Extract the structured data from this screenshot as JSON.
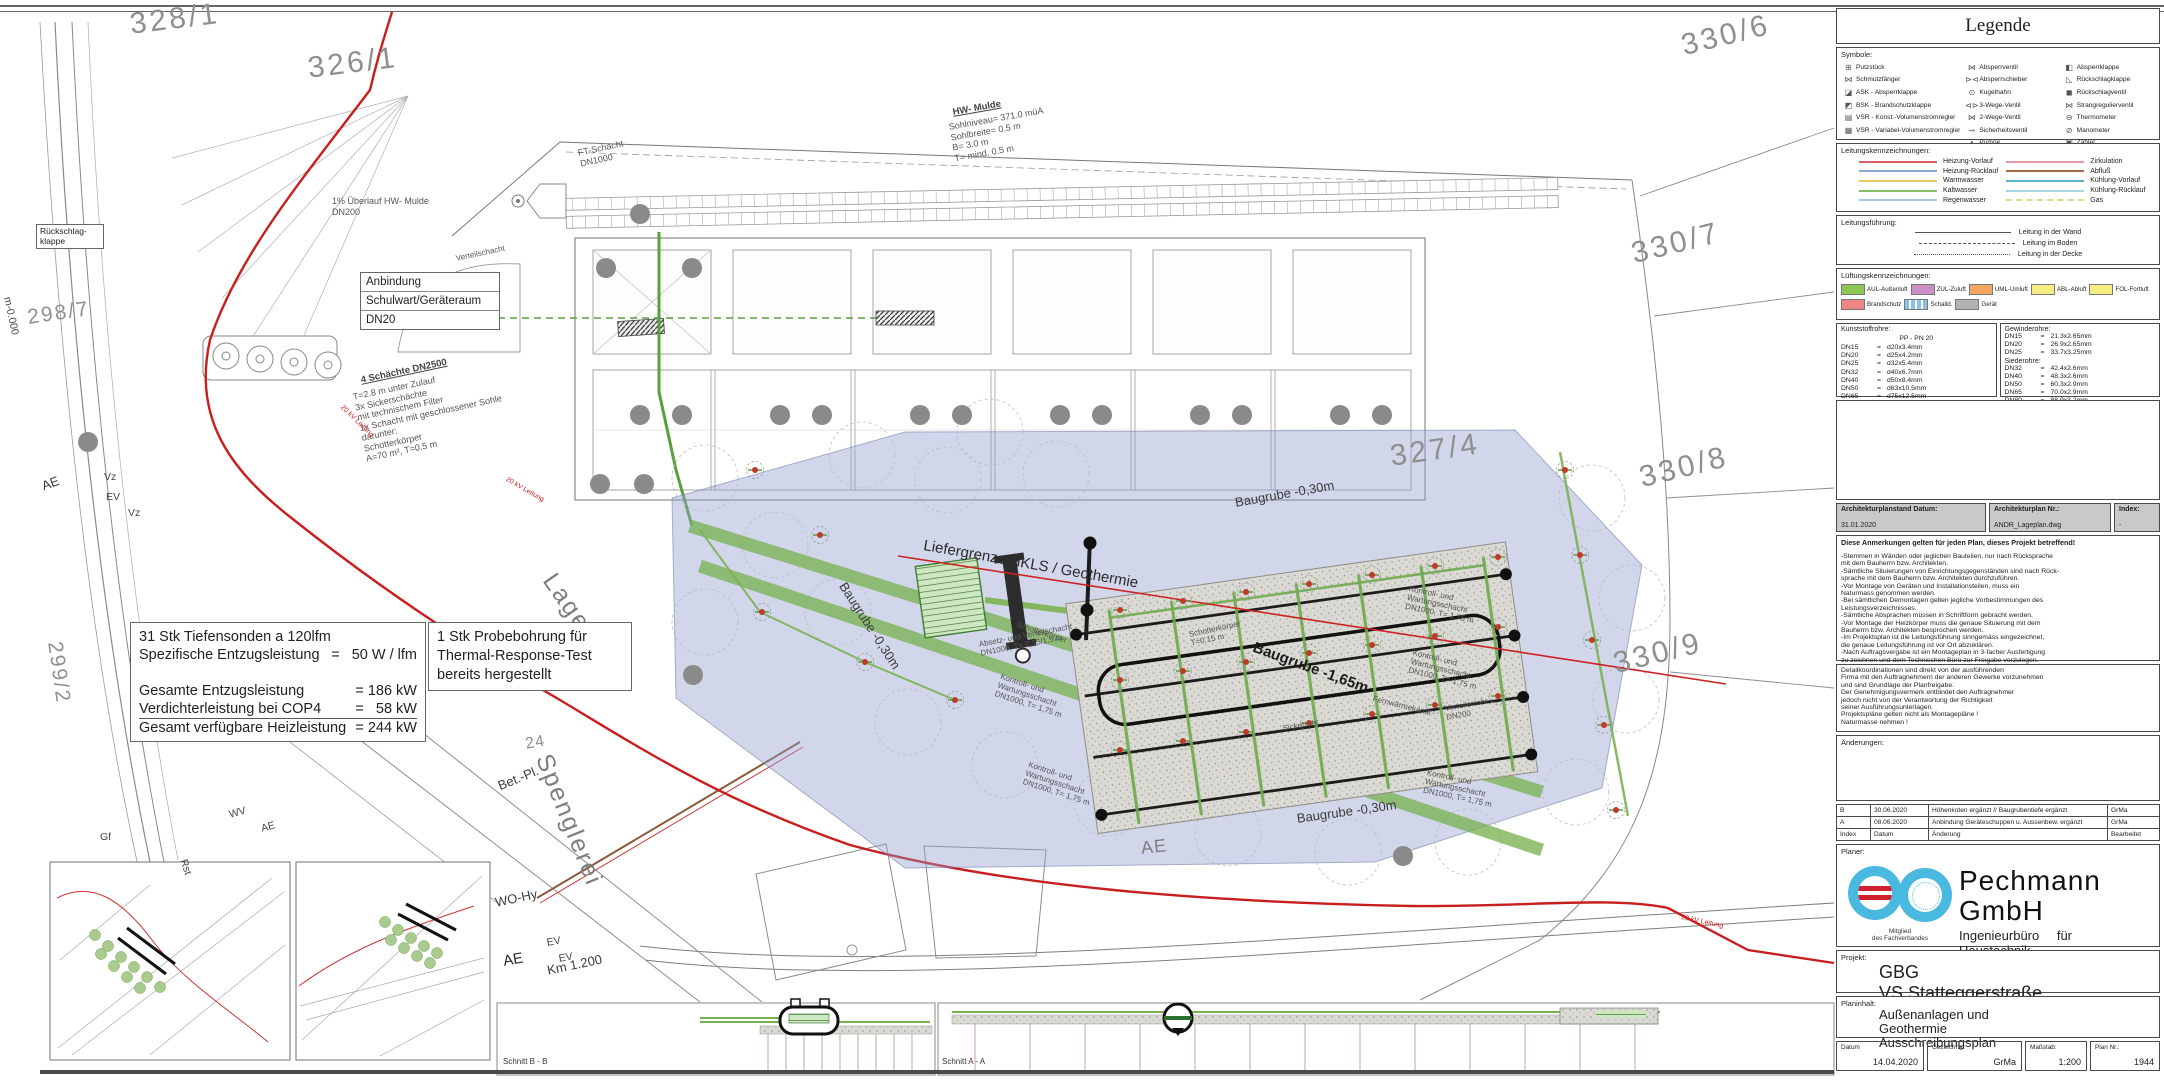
{
  "legend": {
    "title": "Legende",
    "symbols_label": "Symbole:",
    "symbols_col1": [
      {
        "icon": "⊞",
        "name": "putzstueck-icon",
        "label": "Putzstück"
      },
      {
        "icon": "⋈",
        "name": "schmutzfaenger-icon",
        "label": "Schmutzfänger"
      },
      {
        "icon": "◪",
        "name": "ask-icon",
        "label": "ASK  - Absperrklappe"
      },
      {
        "icon": "◩",
        "name": "bsk-icon",
        "label": "BSK  - Brandschutzklappe"
      },
      {
        "icon": "▤",
        "name": "vsr-konst-icon",
        "label": "VSR - Konst.-Volumenstromregler"
      },
      {
        "icon": "▦",
        "name": "vsr-var-icon",
        "label": "VSR - Variabel-Volumenstromregler"
      }
    ],
    "symbols_col2": [
      {
        "icon": "⋈",
        "name": "absperrventil-icon",
        "label": "Absperrventil"
      },
      {
        "icon": "⊳⊲",
        "name": "absperrschieber-icon",
        "label": "Absperrschieber"
      },
      {
        "icon": "⊙",
        "name": "kugelhahn-icon",
        "label": "Kugelhahn"
      },
      {
        "icon": "⊲⊳",
        "name": "drei-wege-ventil-icon",
        "label": "3-Wege-Ventil"
      },
      {
        "icon": "⋈",
        "name": "zwei-wege-ventil-icon",
        "label": "2-Wege-Ventil"
      },
      {
        "icon": "⊸",
        "name": "sicherheitsventil-icon",
        "label": "Sicherheitsventil"
      },
      {
        "icon": "▲",
        "name": "pumpe-icon",
        "label": "Pumpe"
      }
    ],
    "symbols_col3": [
      {
        "icon": "◧",
        "name": "absperrklappe-icon",
        "label": "Absperrklappe"
      },
      {
        "icon": "◺",
        "name": "rueckschlagklappe-icon",
        "label": "Rückschlagklappe"
      },
      {
        "icon": "◼",
        "name": "rueckschlagventil-icon",
        "label": "Rückschlagventil"
      },
      {
        "icon": "⋈",
        "name": "strangregulierventil-icon",
        "label": "Strangregulierventil"
      },
      {
        "icon": "⊖",
        "name": "thermometer-icon",
        "label": "Thermometer"
      },
      {
        "icon": "⊘",
        "name": "manometer-icon",
        "label": "Manometer"
      },
      {
        "icon": "▣",
        "name": "zaehler-icon",
        "label": "Zähler"
      }
    ],
    "line_markings_label": "Leitungskennzeichnungen:",
    "lines_left": [
      {
        "label": "Heizung-Vorlauf",
        "color": "#d96060"
      },
      {
        "label": "Heizung-Rücklauf",
        "color": "#8aa6d6"
      },
      {
        "label": "Warmwasser",
        "color": "#e6cb5a"
      },
      {
        "label": "Kaltwasser",
        "color": "#86bd6a"
      },
      {
        "label": "Regenwasser",
        "color": "#a6cbe8"
      }
    ],
    "lines_right": [
      {
        "label": "Zirkulation",
        "color": "#e59aa8"
      },
      {
        "label": "Abfluß",
        "color": "#a8674a"
      },
      {
        "label": "Kühlung-Vorlauf",
        "color": "#55b4c8"
      },
      {
        "label": "Kühlung-Rücklauf",
        "color": "#a9d6e6"
      },
      {
        "label": "Gas",
        "color": "#ded98a",
        "dash": true
      }
    ],
    "routing_label": "Leitungsführung:",
    "routing": [
      {
        "label": "Leitung in der Wand",
        "style": "solid"
      },
      {
        "label": "Leitung im Boden",
        "style": "dashed"
      },
      {
        "label": "Leitung in der Decke",
        "style": "dotted"
      }
    ],
    "vent_label": "Lüftungskennzeichnungen:",
    "vent_row1": [
      {
        "label": "AUL-Außenluft",
        "color": "#8cc653"
      },
      {
        "label": "ZUL-Zuluft",
        "color": "#cc8fc5"
      },
      {
        "label": "UML-Umluft",
        "color": "#f2a95f"
      },
      {
        "label": "ABL-Abluft",
        "color": "#f4ee82"
      },
      {
        "label": "FOL-Fortluft",
        "color": "#f4ee82"
      }
    ],
    "vent_row2": [
      {
        "label": "Brandschutz",
        "color": "#ef8686"
      },
      {
        "label": "Schalld.",
        "color": "#8cc0ea",
        "striped": true
      },
      {
        "label": "Gerät",
        "color": "#b3b3b3"
      }
    ],
    "plastic_title": "Kunststoffrohre:",
    "plastic_sub": "PP  -  PN 20",
    "plastic_rows": [
      [
        "DN15",
        "=",
        "d20x3.4mm"
      ],
      [
        "DN20",
        "=",
        "d25x4.2mm"
      ],
      [
        "DN25",
        "=",
        "d32x5.4mm"
      ],
      [
        "DN32",
        "=",
        "d40x6.7mm"
      ],
      [
        "DN40",
        "=",
        "d50x8.4mm"
      ],
      [
        "DN50",
        "=",
        "d63x10.5mm"
      ],
      [
        "DN65",
        "=",
        "d75x12.5mm"
      ],
      [
        "DN80",
        "=",
        "d90x15mm"
      ]
    ],
    "threaded_title": "Gewinderohre:",
    "threaded_rows": [
      [
        "DN15",
        "=",
        "21.3x2.65mm"
      ],
      [
        "DN20",
        "=",
        "26.9x2.65mm"
      ],
      [
        "DN25",
        "=",
        "33.7x3.25mm"
      ]
    ],
    "boiler_title": "Siederohre:",
    "boiler_rows": [
      [
        "DN32",
        "=",
        "42.4x2.6mm"
      ],
      [
        "DN40",
        "=",
        "48.3x2.6mm"
      ],
      [
        "DN50",
        "=",
        "60.3x2.9mm"
      ],
      [
        "DN65",
        "=",
        "70.0x2.9mm"
      ],
      [
        "DN80",
        "=",
        "88.9x3.2mm"
      ],
      [
        "DN100",
        "=",
        "114.3x3.6mm"
      ]
    ]
  },
  "plan_meta": {
    "arch_date_label": "Architekturplanstand Datum:",
    "arch_date": "31.01.2020",
    "arch_nr_label": "Architekturplan Nr.:",
    "arch_nr": "ANDR_Lageplan.dwg",
    "index_label": "Index:",
    "index_value": "-"
  },
  "notes": {
    "title": "Diese Anmerkungen gelten für jeden Plan, dieses Projekt betreffend!",
    "lines": [
      "-Stemmen in Wänden oder jeglichen Bauteilen, nur nach Rücksprache",
      " mit dem Bauherrn bzw. Architekten.",
      "-Sämtliche Situierungen von Einrichtungsgegenständen sind nach Rück-",
      " sprache mit dem Bauherrn bzw. Architekten durchzuführen.",
      "-Vor Montage von Geräten und Installationsteilen, muss ein",
      " Naturmass genommen werden.",
      "-Bei sämtlichen Demontagen gelten jegliche Vorbestimmungen des",
      " Leistungsverzeichnisses.",
      "-Sämtliche Absprachen müssen in Schriftform gebracht werden.",
      "-Vor Montage der Heizkörper muss die genaue Situierung mit dem",
      " Bauherrn bzw. Architekten besprochen werden.",
      "-Im Projektsplan ist die Leitungsführung sinngemäss eingezeichnet,",
      " die genaue Leitungsführung ist vor Ort abzuklären.",
      "-Nach Auftragsvergabe ist ein Montageplan in 3-facher Ausfertigung",
      " zu zeichnen und dem Technischen Büro zur Freigabe vorzulegen."
    ]
  },
  "coordination_lines": [
    "Detailkoordinationen sind direkt von der ausführenden",
    "Firma mit den Auftragnehmern der anderen Gewerke vorzunehmen",
    "und sind Grundlage der Planfreigabe.",
    "Der Genehmigungsvermerk entbindet den Auftragnehmer",
    "jedoch nicht von der Verantwortung der Richtigkeit",
    "seiner Ausführungsunterlagen.",
    "Projektspläne gelten nicht als Montagepläne !",
    "Naturmasse nehmen !"
  ],
  "changes_label": "Änderungen:",
  "revisions": {
    "rows": [
      {
        "index": "B",
        "date": "30.06.2020",
        "change": "Höhenkoten ergänzt // Baugrubentiefe ergänzt",
        "by": "GrMa"
      },
      {
        "index": "A",
        "date": "08.06.2020",
        "change": "Anbindung Geräteschuppen u. Aussenbew. ergänzt",
        "by": "GrMa"
      }
    ],
    "header": {
      "index": "Index",
      "date": "Datum",
      "change": "Änderung",
      "by": "Bearbeitet"
    }
  },
  "planner": {
    "label": "Planer:",
    "company": "Pechmann GmbH",
    "subtitle": "Ingenieurbüro für Haustechnik",
    "addr1": "Grazer Straße 48f, A - 8062 Kumberg",
    "addr2": "Tel.: 03132/5485 Fax.: 03132/5485-16",
    "addr3": "e-mail: office@tb-pechmann.at",
    "membership": "Mitglied\ndes Fachverbandes"
  },
  "project": {
    "label": "Projekt:",
    "line1": "GBG",
    "line2": "VS Statteggerstraße"
  },
  "content": {
    "label": "Planinhalt:",
    "lines": [
      "Außenanlagen und",
      "Geothermie",
      "Ausschreibungsplan"
    ]
  },
  "footer": {
    "date_label": "Datum",
    "date": "14.04.2020",
    "drawn_label": "Gezeichnet",
    "drawn": "GrMa",
    "scale_label": "Maßstab:",
    "scale": "1:200",
    "plan_label": "Plan Nr.:",
    "plan_nr": "1944"
  },
  "plan": {
    "colors": {
      "kv_line": "#c81e1e",
      "pipe": "#4e9a3c",
      "borehole": "#c0392b",
      "tree": "#8a8a8a",
      "excavation": "rgba(148,158,204,0.42)"
    },
    "boxes": {
      "anbindung": {
        "lines": [
          "Anbindung",
          "Schulwart/Geräteraum",
          "DN20"
        ]
      },
      "rueckschlag": {
        "text": "Rückschlag-\nklappe"
      },
      "sonden": {
        "rows": [
          [
            "31 Stk Tiefensonden a 120lfm",
            ""
          ],
          [
            "Spezifische Entzugsleistung",
            "=   50 W / lfm"
          ],
          [
            "",
            ""
          ],
          [
            "Gesamte Entzugsleistung",
            "= 186 kW"
          ],
          [
            "Verdichterleistung bei COP4",
            "=   58 kW"
          ],
          [
            "Gesamt verfügbare Heizleistung",
            "= 244 kW"
          ]
        ]
      },
      "probe": {
        "lines": [
          "1 Stk Probebohrung für",
          "Thermal-Response-Test",
          "bereits hergestellt"
        ]
      }
    },
    "labels": [
      {
        "t": "328/1",
        "x": 128,
        "y": 8,
        "r": -7,
        "c": "pxl"
      },
      {
        "t": "326/1",
        "x": 306,
        "y": 52,
        "r": -7,
        "c": "pxl"
      },
      {
        "t": "330/6",
        "x": 1678,
        "y": 30,
        "r": -14,
        "c": "pxl"
      },
      {
        "t": "330/7",
        "x": 1628,
        "y": 238,
        "r": -14,
        "c": "pxl"
      },
      {
        "t": "330/8",
        "x": 1636,
        "y": 462,
        "r": -14,
        "c": "pxl"
      },
      {
        "t": "330/9",
        "x": 1610,
        "y": 648,
        "r": -14,
        "c": "pxl"
      },
      {
        "t": "327/4",
        "x": 1388,
        "y": 440,
        "r": -8,
        "c": "pxl"
      },
      {
        "t": "298/7",
        "x": 26,
        "y": 306,
        "r": -8,
        "c": "pmd"
      },
      {
        "t": "299/2",
        "x": 66,
        "y": 640,
        "r": 82,
        "c": "pmd"
      },
      {
        "t": "24",
        "x": 524,
        "y": 736,
        "r": -10,
        "c": "psm"
      },
      {
        "t": "Lagerhalle",
        "x": 560,
        "y": 568,
        "r": 55,
        "c": "street"
      },
      {
        "t": "Spenglerei",
        "x": 556,
        "y": 750,
        "r": 68,
        "c": "street"
      },
      {
        "t": "HW- Mulde",
        "x": 952,
        "y": 108,
        "r": -10,
        "c": "noteb"
      },
      {
        "t": "Sohlniveau= 371.0 müA\nSohlbreite= 0.5 m\nB= 3.0 m\nT= mind. 0.5 m",
        "x": 948,
        "y": 122,
        "r": -10,
        "c": "note"
      },
      {
        "t": "FT-Schacht\nDN1000",
        "x": 577,
        "y": 148,
        "r": -12,
        "c": "note"
      },
      {
        "t": "1% Überlauf HW- Mulde\nDN200",
        "x": 332,
        "y": 196,
        "r": 0,
        "c": "note"
      },
      {
        "t": "4 Schächte DN2500",
        "x": 360,
        "y": 376,
        "r": -12,
        "c": "noteb"
      },
      {
        "t": "T=2.8 m unter Zulauf\n3x Sickerschächte\nmit technischem Filter\n1x Schacht mit geschlossener Sohle\ndarunter:\nSchotterkörper\nA=70 m², T=0.5 m",
        "x": 352,
        "y": 392,
        "r": -12,
        "c": "note"
      },
      {
        "t": "Verteilschacht",
        "x": 455,
        "y": 254,
        "r": -12,
        "c": "note6"
      },
      {
        "t": "Liefergrenze HKLS / Geothermie",
        "x": 925,
        "y": 538,
        "r": 10,
        "c": "lblb"
      },
      {
        "t": "Baugrube -0,30m",
        "x": 848,
        "y": 580,
        "r": 57,
        "c": "lbl"
      },
      {
        "t": "Baugrube -0,30m",
        "x": 1234,
        "y": 496,
        "r": -10,
        "c": "lbl"
      },
      {
        "t": "Baugrube -0,30m",
        "x": 1296,
        "y": 812,
        "r": -8,
        "c": "lbl"
      },
      {
        "t": "Baugrube -1,65m",
        "x": 1256,
        "y": 640,
        "r": 20,
        "c": "lblb2"
      },
      {
        "t": "Kontroll- und\nWartungsschacht\nDN1000, T= 1,75 m",
        "x": 1410,
        "y": 584,
        "r": 12,
        "c": "note6"
      },
      {
        "t": "Kontroll- und\nWartungsschacht\nDN1000, T= 1,75 m",
        "x": 1414,
        "y": 648,
        "r": 14,
        "c": "note6"
      },
      {
        "t": "Kontroll- und\nWartungsschacht\nDN1000, T= 1,75 m",
        "x": 1428,
        "y": 768,
        "r": 12,
        "c": "note6"
      },
      {
        "t": "Kontroll- und\nWartungsschacht\nDN1000, T= 1,75 m",
        "x": 1002,
        "y": 672,
        "r": 18,
        "c": "note6"
      },
      {
        "t": "Kontroll- und\nWartungsschacht\nDN1000, T= 1,75 m",
        "x": 1030,
        "y": 760,
        "r": 18,
        "c": "note6"
      },
      {
        "t": "Absetz- und Verteilschacht\nDN1000, T= 2,15/1,5 m",
        "x": 978,
        "y": 640,
        "r": -11,
        "c": "note6"
      },
      {
        "t": "Schotterkörper\nT=0.15 m",
        "x": 1188,
        "y": 630,
        "r": -12,
        "c": "note6"
      },
      {
        "t": "Schotterkörper",
        "x": 1018,
        "y": 620,
        "r": 18,
        "c": "note6"
      },
      {
        "t": "Verteilerrohr\nDN200",
        "x": 1444,
        "y": 704,
        "r": -10,
        "c": "note6"
      },
      {
        "t": "Sickerrohr",
        "x": 1282,
        "y": 724,
        "r": -10,
        "c": "note6"
      },
      {
        "t": "Fernwärmekanal",
        "x": 1374,
        "y": 694,
        "r": 14,
        "c": "note6"
      },
      {
        "t": "AE",
        "x": 40,
        "y": 480,
        "r": -20,
        "c": "lbl"
      },
      {
        "t": "Vz",
        "x": 104,
        "y": 472,
        "r": 0,
        "c": "lbls"
      },
      {
        "t": "EV",
        "x": 106,
        "y": 492,
        "r": 0,
        "c": "lbls"
      },
      {
        "t": "Vz",
        "x": 128,
        "y": 508,
        "r": 0,
        "c": "lbls"
      },
      {
        "t": "Gf",
        "x": 100,
        "y": 832,
        "r": 0,
        "c": "lbls"
      },
      {
        "t": "Rst",
        "x": 188,
        "y": 858,
        "r": 72,
        "c": "lbls"
      },
      {
        "t": "WV",
        "x": 228,
        "y": 810,
        "r": -15,
        "c": "lbls"
      },
      {
        "t": "AE",
        "x": 260,
        "y": 824,
        "r": -15,
        "c": "lbls"
      },
      {
        "t": "m-0.000",
        "x": 12,
        "y": 296,
        "r": 78,
        "c": "lbls"
      },
      {
        "t": "Bet.-Pl.",
        "x": 496,
        "y": 780,
        "r": -22,
        "c": "lbl"
      },
      {
        "t": "WO-Hy",
        "x": 494,
        "y": 896,
        "r": -12,
        "c": "lbl"
      },
      {
        "t": "AE",
        "x": 502,
        "y": 954,
        "r": -10,
        "c": "lblb"
      },
      {
        "t": "EV",
        "x": 546,
        "y": 938,
        "r": -10,
        "c": "lbls"
      },
      {
        "t": "EV",
        "x": 558,
        "y": 954,
        "r": -10,
        "c": "lbls"
      },
      {
        "t": "Km 1.200",
        "x": 546,
        "y": 964,
        "r": -12,
        "c": "lbl"
      },
      {
        "t": "AE",
        "x": 1140,
        "y": 838,
        "r": -6,
        "c": "street2"
      },
      {
        "t": "20 kV Leitung",
        "x": 344,
        "y": 404,
        "r": 44,
        "c": "redxs"
      },
      {
        "t": "20 kV Leitung",
        "x": 508,
        "y": 476,
        "r": 30,
        "c": "redxs"
      },
      {
        "t": "20 kV Leitung",
        "x": 1682,
        "y": 914,
        "r": 12,
        "c": "redxs"
      },
      {
        "t": "Schnitt B - B",
        "x": 503,
        "y": 1058,
        "r": 0,
        "c": "lbl7"
      },
      {
        "t": "Schnitt A - A",
        "x": 942,
        "y": 1058,
        "r": 0,
        "c": "lbl7"
      }
    ],
    "boreholes": [
      [
        1120,
        610
      ],
      [
        1183,
        601
      ],
      [
        1246,
        592
      ],
      [
        1309,
        584
      ],
      [
        1372,
        575
      ],
      [
        1435,
        566
      ],
      [
        1498,
        557
      ],
      [
        1120,
        680
      ],
      [
        1183,
        671
      ],
      [
        1246,
        662
      ],
      [
        1309,
        653
      ],
      [
        1372,
        645
      ],
      [
        1435,
        636
      ],
      [
        1498,
        627
      ],
      [
        1120,
        750
      ],
      [
        1183,
        741
      ],
      [
        1246,
        732
      ],
      [
        1309,
        723
      ],
      [
        1372,
        714
      ],
      [
        1435,
        705
      ],
      [
        1498,
        696
      ],
      [
        1565,
        470
      ],
      [
        1580,
        555
      ],
      [
        1592,
        640
      ],
      [
        1604,
        725
      ],
      [
        1616,
        810
      ],
      [
        755,
        470
      ],
      [
        820,
        535
      ],
      [
        762,
        612
      ],
      [
        865,
        662
      ],
      [
        955,
        700
      ]
    ],
    "trees": [
      [
        640,
        415
      ],
      [
        682,
        415
      ],
      [
        780,
        415
      ],
      [
        822,
        415
      ],
      [
        920,
        415
      ],
      [
        962,
        415
      ],
      [
        1060,
        415
      ],
      [
        1102,
        415
      ],
      [
        1200,
        415
      ],
      [
        1242,
        415
      ],
      [
        1340,
        415
      ],
      [
        1382,
        415
      ],
      [
        606,
        268
      ],
      [
        692,
        268
      ],
      [
        640,
        214
      ],
      [
        600,
        484
      ],
      [
        644,
        484
      ],
      [
        88,
        442
      ],
      [
        693,
        675
      ],
      [
        1403,
        856
      ]
    ],
    "canopies": [
      [
        705,
        478
      ],
      [
        775,
        545
      ],
      [
        705,
        622
      ],
      [
        838,
        612
      ],
      [
        948,
        480
      ],
      [
        1056,
        474
      ],
      [
        908,
        722
      ],
      [
        1005,
        765
      ],
      [
        1108,
        803
      ],
      [
        1228,
        833
      ],
      [
        1348,
        852
      ],
      [
        1468,
        842
      ],
      [
        1576,
        792
      ],
      [
        1626,
        700
      ],
      [
        1632,
        598
      ],
      [
        1592,
        498
      ],
      [
        862,
        455
      ],
      [
        990,
        432
      ]
    ]
  }
}
